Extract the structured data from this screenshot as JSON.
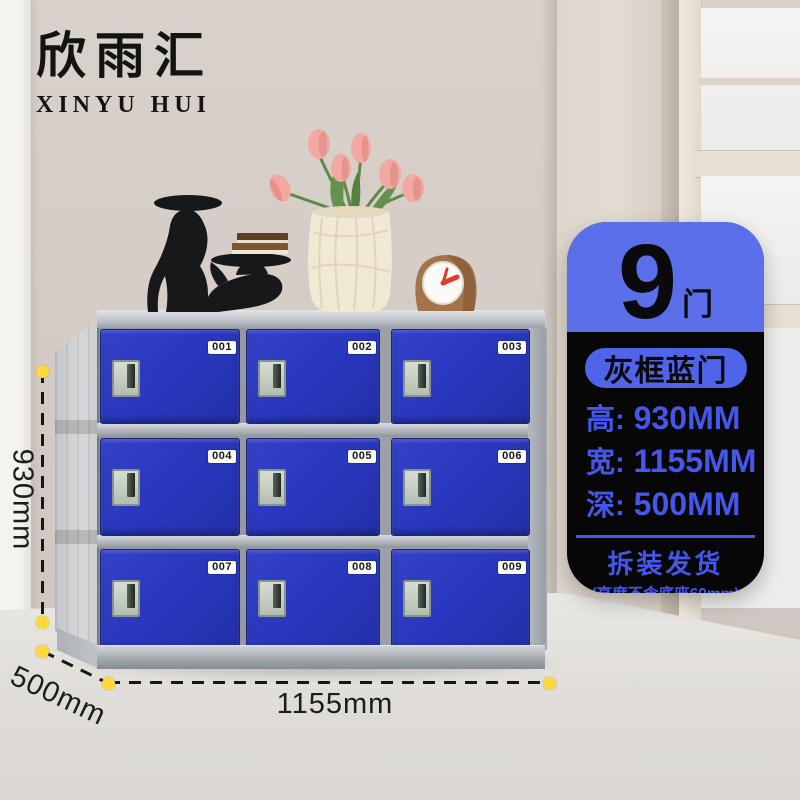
{
  "logo": {
    "chinese": "欣雨汇",
    "english": "XINYU HUI"
  },
  "info_card": {
    "door_count": "9",
    "door_unit": "门",
    "variant_badge": "灰框蓝门",
    "specs": [
      {
        "label": "高:",
        "value": "930MM"
      },
      {
        "label": "宽:",
        "value": "1155MM"
      },
      {
        "label": "深:",
        "value": "500MM"
      }
    ],
    "shipping": "拆装发货",
    "shipping_note": "(高度不含底座60mm)"
  },
  "dimension_labels": {
    "height": "930mm",
    "depth": "500mm",
    "width": "1155mm"
  },
  "locker": {
    "doors": [
      {
        "number": "001"
      },
      {
        "number": "002"
      },
      {
        "number": "003"
      },
      {
        "number": "004"
      },
      {
        "number": "005"
      },
      {
        "number": "006"
      },
      {
        "number": "007"
      },
      {
        "number": "008"
      },
      {
        "number": "009"
      }
    ]
  },
  "decor": {
    "items": [
      "greyhound-tray-figurine",
      "lying-greyhound-tray-figurine",
      "stacked-books",
      "paper-vase-with-pink-tulips",
      "wooden-desk-clock"
    ]
  },
  "colors": {
    "door_blue": "#2B38BE",
    "frame_silver": "#B8BDC3",
    "card_header_blue": "#5A6FE9",
    "card_body_black": "#070708",
    "card_text_blue": "#4457E8",
    "badge_pill_blue": "#4F64E8",
    "dimension_dot_yellow": "#FFD83B"
  }
}
